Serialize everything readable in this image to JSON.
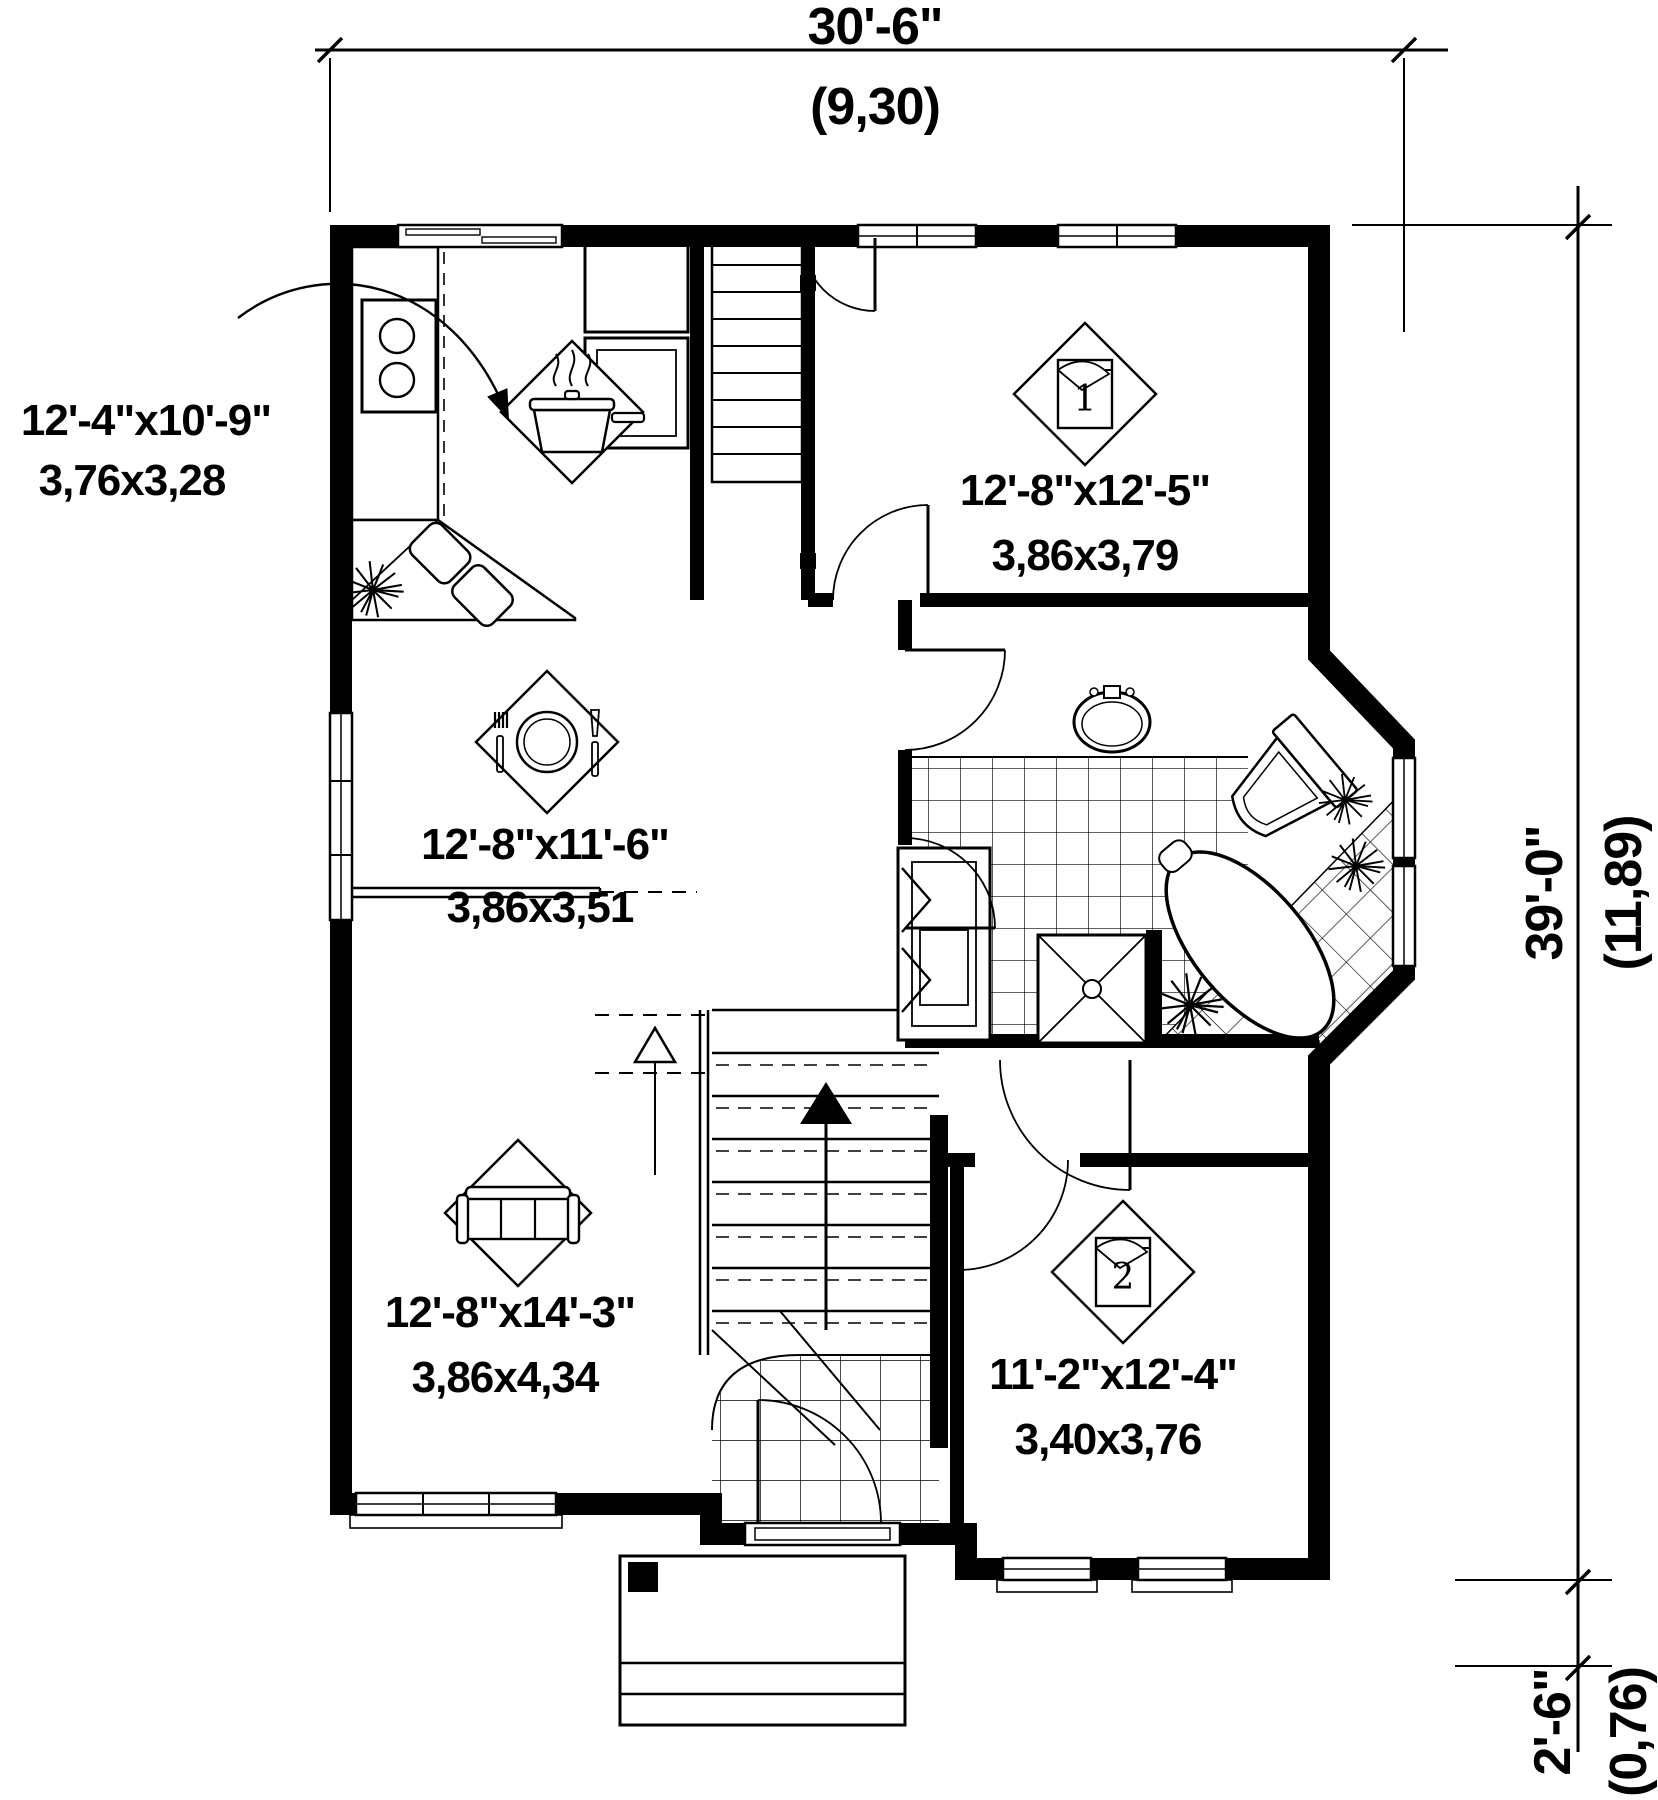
{
  "drawing": {
    "type": "house floor plan",
    "line_color": "#000000",
    "background": "#ffffff"
  },
  "dimensions": {
    "top": {
      "imperial": "30'-6\"",
      "metric": "(9,30)"
    },
    "right": {
      "imperial": "39'-0\"",
      "metric": "(11,89)"
    },
    "bottom_right": {
      "imperial": "2'-6\"",
      "metric": "(0,76)"
    }
  },
  "rooms": {
    "kitchen": {
      "imperial": "12'-4\"x10'-9\"",
      "metric": "3,76x3,28",
      "icon": "cooking-pot"
    },
    "bedroom1": {
      "imperial": "12'-8\"x12'-5\"",
      "metric": "3,86x3,79",
      "icon": "bed",
      "number": "1"
    },
    "dining": {
      "imperial": "12'-8\"x11'-6\"",
      "metric": "3,86x3,51",
      "icon": "place-setting"
    },
    "living": {
      "imperial": "12'-8\"x14'-3\"",
      "metric": "3,86x4,34",
      "icon": "sofa"
    },
    "bedroom2": {
      "imperial": "11'-2\"x12'-4\"",
      "metric": "3,40x3,76",
      "icon": "bed",
      "number": "2"
    }
  }
}
